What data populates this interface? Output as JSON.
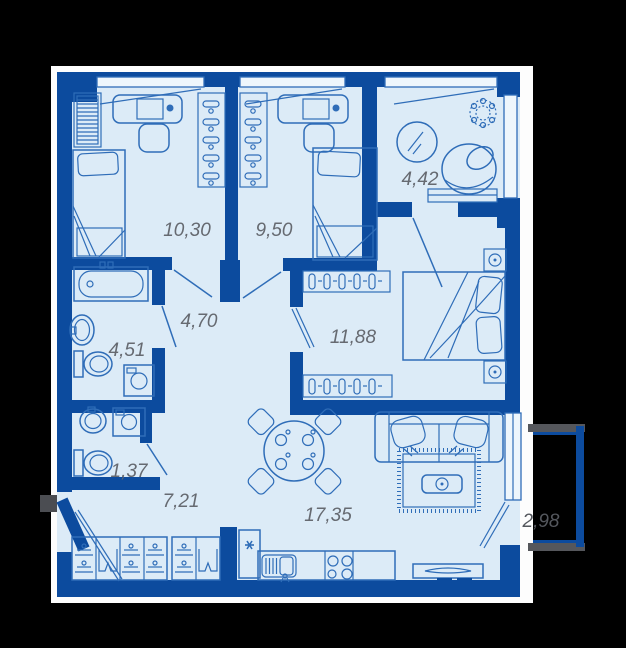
{
  "title": "Apartment floor plan",
  "rooms": [
    {
      "id": "bedroom-1",
      "area": "10,30"
    },
    {
      "id": "bedroom-2",
      "area": "9,50"
    },
    {
      "id": "dressing-room",
      "area": "4,42"
    },
    {
      "id": "hallway",
      "area": "4,70"
    },
    {
      "id": "bedroom-3",
      "area": "11,88"
    },
    {
      "id": "bathroom",
      "area": "4,51"
    },
    {
      "id": "wc",
      "area": "1,37"
    },
    {
      "id": "corridor",
      "area": "7,21"
    },
    {
      "id": "living-kitchen",
      "area": "17,35"
    }
  ],
  "balcony": {
    "area": "2,98"
  },
  "colors": {
    "background": "#000000",
    "backing": "#fdfdfd",
    "wall": "#0c4b9e",
    "floor": "#dcebf7",
    "window_fill": "#eef6fc",
    "furniture_line": "#2f6db8",
    "label_text": "#666a71",
    "balcony_outline_gray": "#55575c",
    "entry_stub_gray": "#4b4d52"
  },
  "furniture_icons": [
    "bed-icon",
    "desk-icon",
    "chair-icon",
    "wardrobe-hangers-icon",
    "shelf-unit-icon",
    "mirror-icon",
    "plant-icon",
    "armchair-icon",
    "console-icon",
    "nightstand-icon",
    "bathtub-icon",
    "sink-icon",
    "toilet-icon",
    "washing-machine-icon",
    "washbasin-icon",
    "hall-closet-icon",
    "fridge-icon",
    "kitchen-sink-icon",
    "stove-icon",
    "tv-stand-icon",
    "dining-table-icon",
    "sofa-icon",
    "rug-icon",
    "coffee-table-icon"
  ]
}
